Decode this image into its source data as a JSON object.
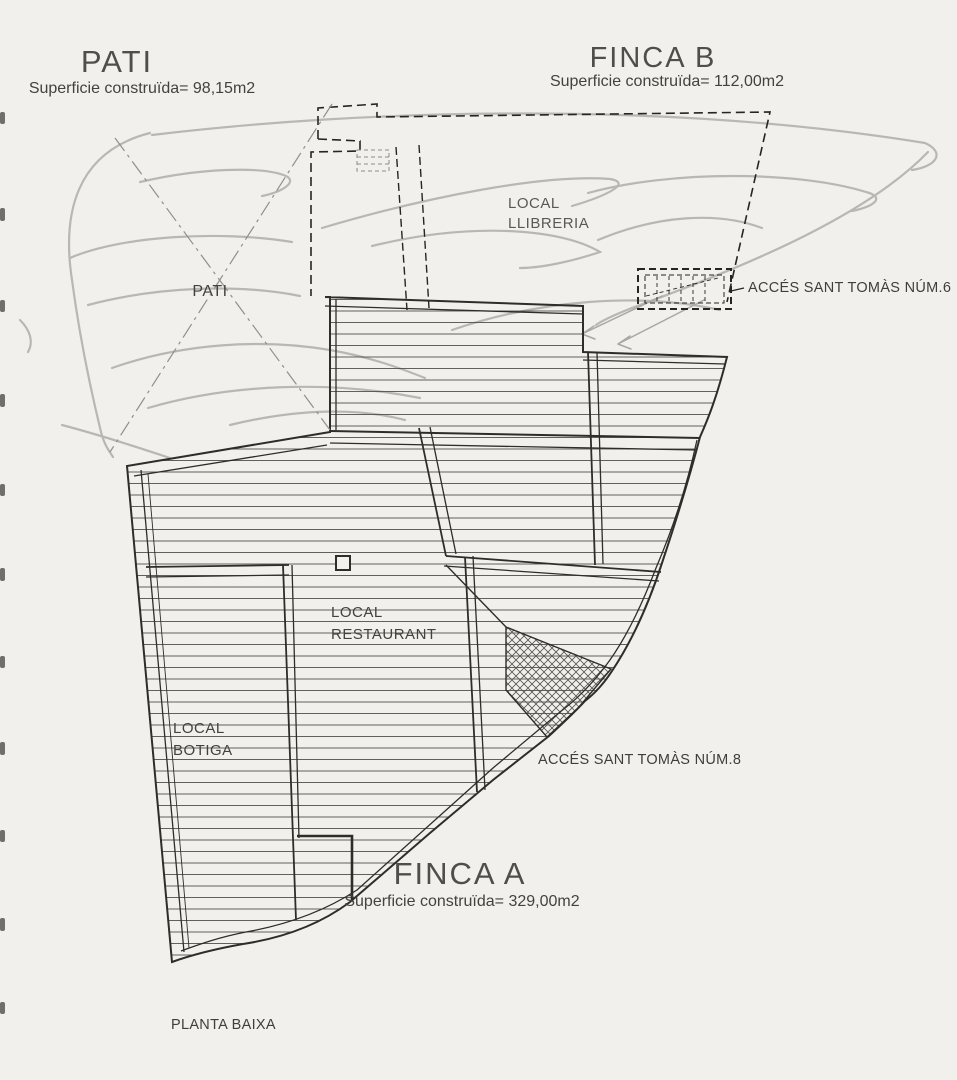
{
  "page": {
    "type_label": "PLANTA BAIXA"
  },
  "pati": {
    "title": "PATI",
    "area_label": "Superficie construïda= 98,15m2",
    "room_label": "PATI"
  },
  "finca_b": {
    "title": "FINCA B",
    "area_label": "Superficie construïda= 112,00m2",
    "room": {
      "line1": "LOCAL",
      "line2": "LLIBRERIA"
    },
    "access_label": "ACCÉS SANT TOMÀS NÚM.6"
  },
  "finca_a": {
    "title": "FINCA A",
    "area_label": "Superficie construïda= 329,00m2",
    "room_restaurant": {
      "line1": "LOCAL",
      "line2": "RESTAURANT"
    },
    "room_botiga": {
      "line1": "LOCAL",
      "line2": "BOTIGA"
    },
    "access_label": "ACCÉS SANT TOMÀS NÚM.8"
  },
  "colors": {
    "paper": "#f1f0ec",
    "ink": "#2e2d2b",
    "hatch": "#504f4c",
    "pencil": "#b6b4af",
    "text": "#413f3c"
  }
}
